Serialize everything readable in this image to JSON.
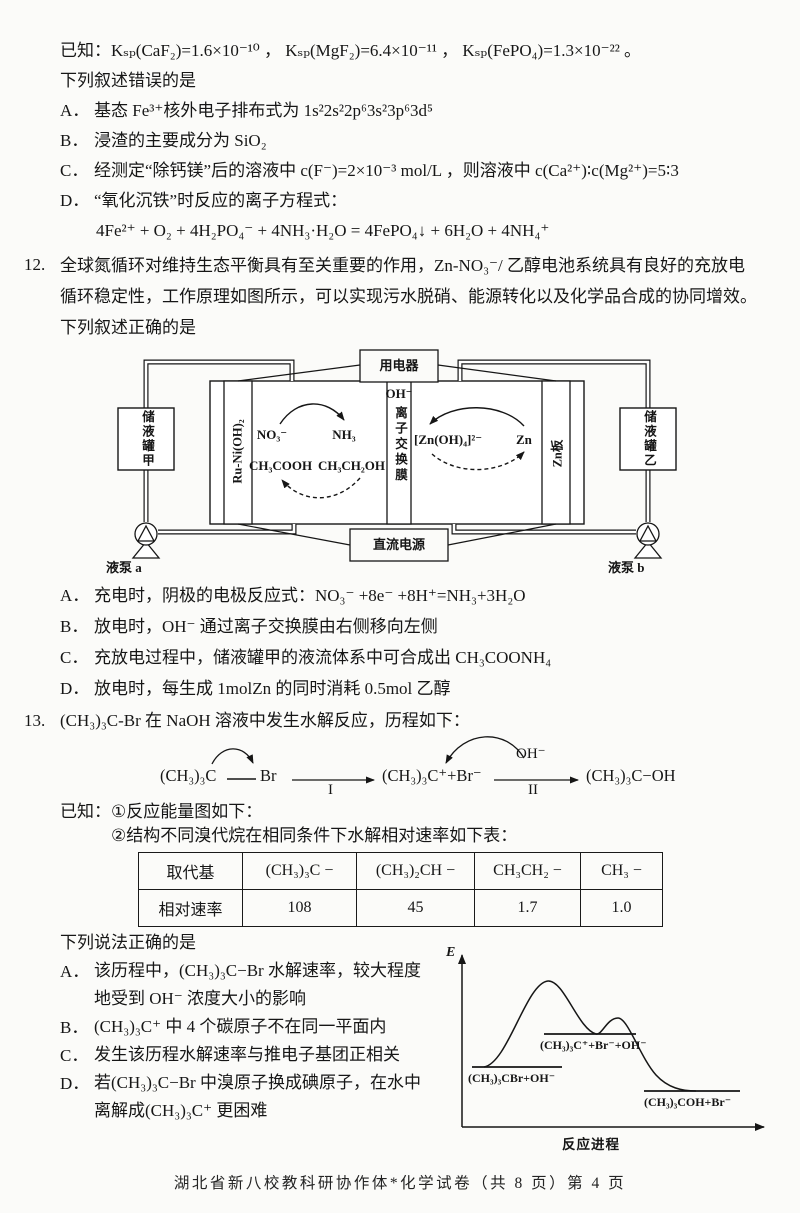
{
  "page": {
    "footer": "湖北省新八校教科研协作体*化学试卷（共 8 页）第 4 页"
  },
  "q11": {
    "known_line": "已知：Kₛₚ(CaF₂)=1.6×10⁻¹⁰ ，  Kₛₚ(MgF₂)=6.4×10⁻¹¹ ，  Kₛₚ(FePO₄)=1.3×10⁻²² 。",
    "stem": "下列叙述错误的是",
    "options": [
      {
        "label": "A．",
        "text": "基态 Fe³⁺核外电子排布式为 1s²2s²2p⁶3s²3p⁶3d⁵"
      },
      {
        "label": "B．",
        "text": "浸渣的主要成分为 SiO₂"
      },
      {
        "label": "C．",
        "text": "经测定“除钙镁”后的溶液中 c(F⁻)=2×10⁻³ mol/L ，则溶液中 c(Ca²⁺)∶c(Mg²⁺)=5∶3"
      },
      {
        "label": "D．",
        "text": "“氧化沉铁”时反应的离子方程式："
      }
    ],
    "d_equation": "4Fe²⁺ + O₂ + 4H₂PO₄⁻ + 4NH₃·H₂O = 4FePO₄↓ + 6H₂O + 4NH₄⁺"
  },
  "q12": {
    "number": "12.",
    "stem_lines": [
      "全球氮循环对维持生态平衡具有至关重要的作用，Zn-NO₃⁻/ 乙醇电池系统具有良好的充放电",
      "循环稳定性，工作原理如图所示，可以实现污水脱硝、能源转化以及化学品合成的协同增效。",
      "下列叙述正确的是"
    ],
    "diagram": {
      "load": "用电器",
      "dc": "直流电源",
      "tank_a": "储液罐甲",
      "tank_b": "储液罐乙",
      "electrode_left": "Ru-Ni(OH)₂",
      "electrode_right": "Zn板",
      "membrane_ion": "OH⁻",
      "membrane_label": "离子交换膜",
      "no3": "NO₃⁻",
      "nh3": "NH₃",
      "acoh": "CH₃COOH",
      "etoh": "CH₃CH₂OH",
      "zincate": "[Zn(OH)₄]²⁻",
      "zn": "Zn",
      "pump_a": "液泵 a",
      "pump_b": "液泵 b"
    },
    "options": [
      {
        "label": "A．",
        "text": "充电时，阴极的电极反应式：NO₃⁻ +8e⁻ +8H⁺=NH₃+3H₂O"
      },
      {
        "label": "B．",
        "text": "放电时，OH⁻ 通过离子交换膜由右侧移向左侧"
      },
      {
        "label": "C．",
        "text": "充放电过程中，储液罐甲的液流体系中可合成出 CH₃COONH₄"
      },
      {
        "label": "D．",
        "text": "放电时，每生成 1molZn 的同时消耗 0.5mol 乙醇"
      }
    ]
  },
  "q13": {
    "number": "13.",
    "stem": "(CH₃)₃C-Br 在 NaOH 溶液中发生水解反应，历程如下：",
    "scheme": {
      "reactant": "(CH₃)₃C",
      "leaving": "Br",
      "step1": "I",
      "intermediate": "(CH₃)₃C⁺+Br⁻",
      "reagent": "OH⁻",
      "step2": "II",
      "product": "(CH₃)₃C−OH"
    },
    "known1": "已知：①反应能量图如下：",
    "known2": "②结构不同溴代烷在相同条件下水解相对速率如下表：",
    "table": {
      "headers": [
        "取代基",
        "(CH₃)₃C −",
        "(CH₃)₂CH −",
        "CH₃CH₂ −",
        "CH₃ −"
      ],
      "row_label": "相对速率",
      "values": [
        "108",
        "45",
        "1.7",
        "1.0"
      ]
    },
    "stem2": "下列说法正确的是",
    "options": [
      {
        "label": "A．",
        "lines": [
          "该历程中，(CH₃)₃C−Br 水解速率，较大程度",
          "地受到 OH⁻ 浓度大小的影响"
        ]
      },
      {
        "label": "B．",
        "lines": [
          "(CH₃)₃C⁺ 中 4 个碳原子不在同一平面内"
        ]
      },
      {
        "label": "C．",
        "lines": [
          "发生该历程水解速率与推电子基团正相关"
        ]
      },
      {
        "label": "D．",
        "lines": [
          "若(CH₃)₃C−Br 中溴原子换成碘原子，在水中",
          "离解成(CH₃)₃C⁺ 更困难"
        ]
      }
    ],
    "energy": {
      "ylabel": "E",
      "xlabel": "反应进程",
      "level1": "(CH₃)₃CBr+OH⁻",
      "level2": "(CH₃)₃C⁺+Br⁻+OH⁻",
      "level3": "(CH₃)₃COH+Br⁻"
    }
  }
}
